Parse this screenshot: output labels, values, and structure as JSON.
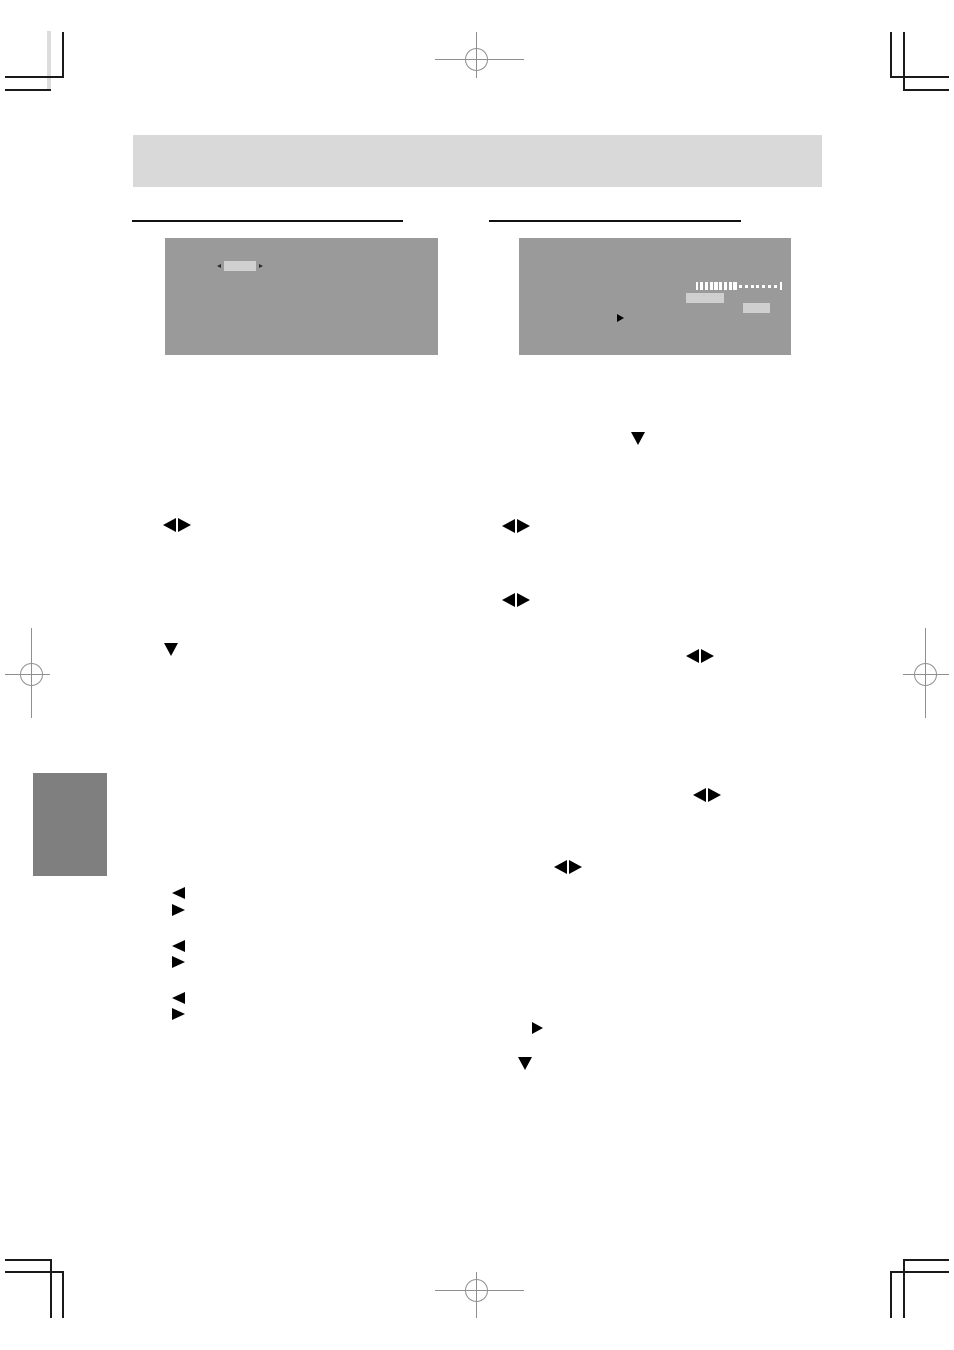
{
  "page": {
    "kind": "scanned-manual-page",
    "visible_text": "",
    "background_color": "#ffffff",
    "width_px": 954,
    "height_px": 1350
  },
  "header": {
    "bar_color": "#d9d9d9",
    "title_text": ""
  },
  "colors": {
    "osd_screen_bg": "#9a9a9a",
    "osd_highlight": "#d0d0d0",
    "level_bar_segments": "#ffffff",
    "side_tab": "#7f7f7f",
    "crop_mark": "#1a1a1a",
    "registration_mark": "#8f8f8f",
    "arrow_glyphs": "#000000"
  },
  "osd_screens": {
    "left": {
      "description": "gray on-screen-display capture with one highlighted value box flanked by small left/right adjust arrows",
      "highlight_color": "#d0d0d0",
      "icons": [
        "tiny-left-arrow-icon",
        "tiny-right-arrow-icon"
      ]
    },
    "right": {
      "description": "gray on-screen-display capture with segmented level bar, two highlighted boxes and a right-pointing cursor arrow",
      "highlight_color": "#cfcfcf",
      "cursor_icon": "right-arrow-icon",
      "level_bar": {
        "type": "segmented-level-indicator",
        "filled_segments": 8,
        "unfilled_segments": 7,
        "segment_color": "#ffffff",
        "has_end_ticks": true
      }
    }
  },
  "glyph_inventory": {
    "left_column": [
      "left-right-arrow-icon",
      "down-arrow-icon",
      "left-arrow-icon",
      "right-arrow-icon",
      "left-arrow-icon",
      "right-arrow-icon",
      "left-arrow-icon",
      "right-arrow-icon"
    ],
    "right_column": [
      "down-arrow-icon",
      "left-right-arrow-icon",
      "left-right-arrow-icon",
      "left-right-arrow-icon",
      "left-right-arrow-icon",
      "left-right-arrow-icon",
      "right-arrow-icon",
      "down-arrow-icon"
    ]
  },
  "print_marks": {
    "corners": [
      "top-left",
      "top-right",
      "bottom-left",
      "bottom-right"
    ],
    "centers": [
      "top-center",
      "bottom-center",
      "left-middle",
      "right-middle"
    ]
  }
}
